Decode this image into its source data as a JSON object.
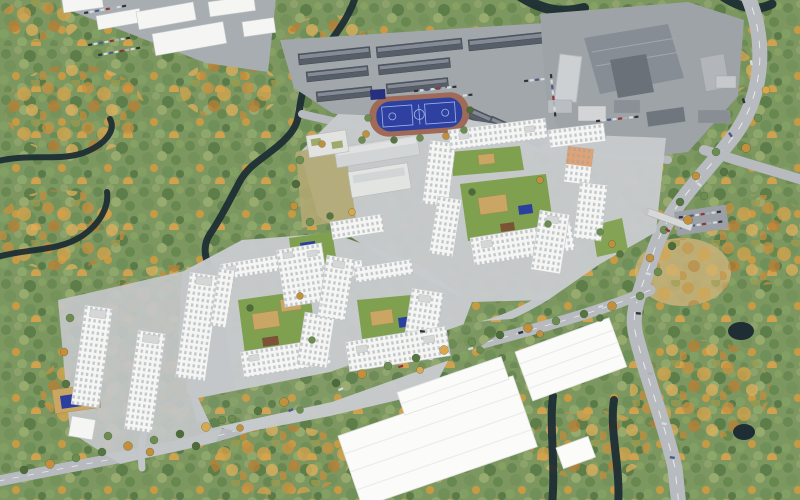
{
  "scene": {
    "kind": "aerial-3d-render",
    "subject": "residential-masterplan-in-autumn-forest",
    "regions": {
      "forest": "autumn-mixed-forest",
      "river": "winding-dark-river",
      "residential": "white-apartment-perimeter-blocks",
      "towers": "high-rise-towers",
      "school": "school-and-kindergarten",
      "sports_field": "blue-stadium-with-basketball-courts",
      "garages": "garage-rows-industrial-zone",
      "factory": "factory-complex",
      "warehouses": "white-warehouse-boxes",
      "roads": "curving-arterial-road-and-boulevard"
    }
  },
  "palette": {
    "forest_green": "#7d9761",
    "autumn_orange": "#c9953f",
    "dry_patch": "#c3b078",
    "river": "#1e2e34",
    "road_main": "#b7bbbf",
    "road_inner": "#c2c6c8",
    "pavement": "#a8adb1",
    "pad": "#c7cacc",
    "building_white": "#f5f6f3",
    "warehouse_white": "#fbfbf9",
    "garage_roof": "#575e68",
    "factory_roof": "#878d94",
    "factory_roof_dark": "#6b7178",
    "sport_blue": "#2f41a0",
    "court_blue": "#2b3f9e",
    "court_blue_dark": "#25307e",
    "track_red": "#a06a59",
    "playground_tan": "#caa665",
    "courtyard_green": "#7fa04f",
    "grass_slope": "#85a355",
    "window_gray": "#9aa1a9",
    "orange_facade": "#d98f56"
  }
}
